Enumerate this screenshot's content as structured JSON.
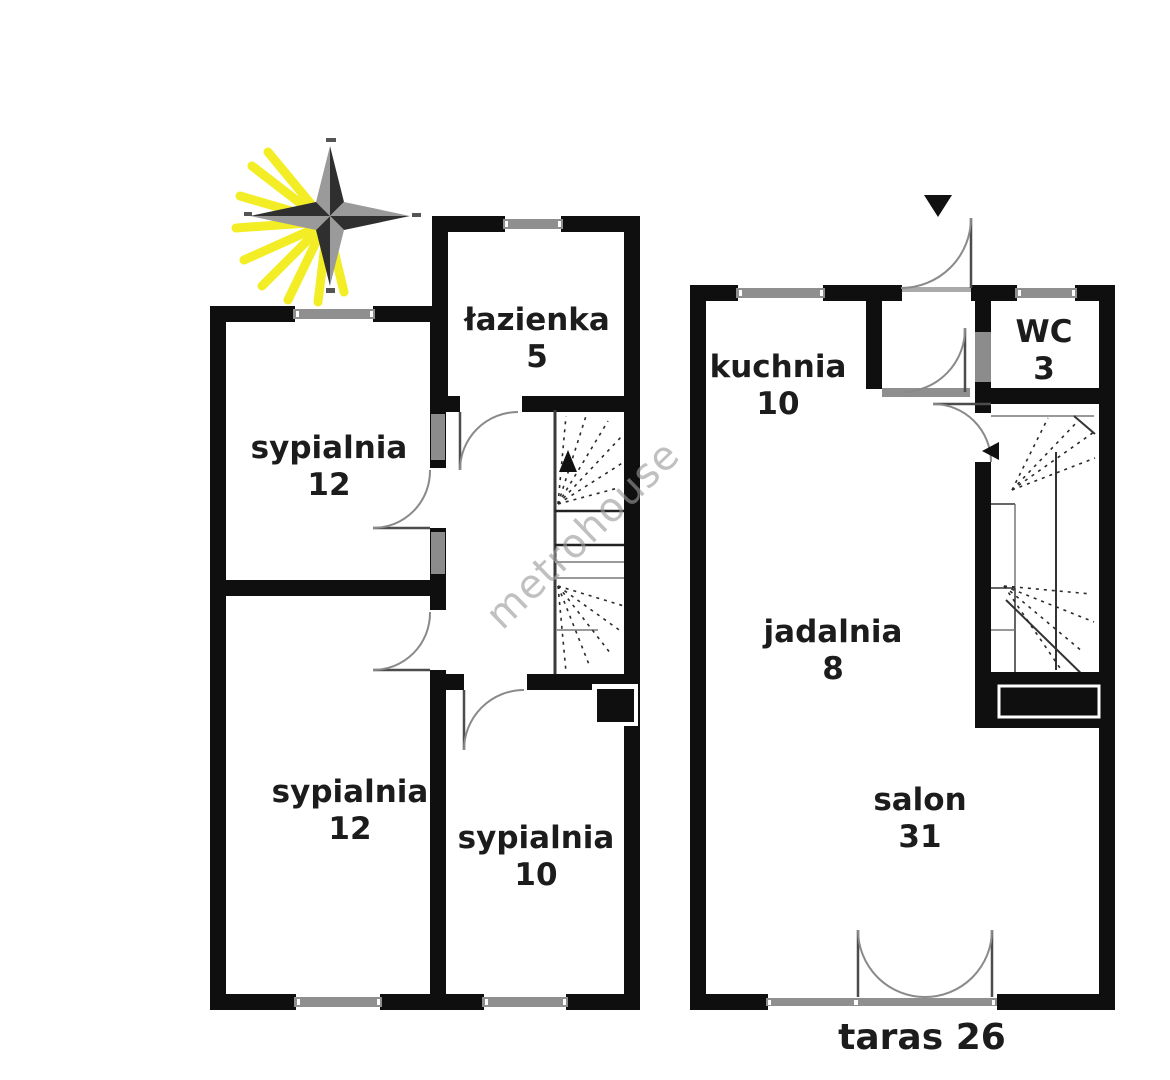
{
  "watermark": {
    "text": "metrohouse",
    "color": "#9b9b9b"
  },
  "icons": {
    "compass": "compass-rose-icon",
    "entrance": "entrance-arrow-icon",
    "stairs_up_upper_floor": "stairs-direction-arrow-icon",
    "stairs_up_ground_floor": "stairs-direction-arrow-icon"
  },
  "colors": {
    "wall": "#0f0f0f",
    "window_glass": "#8f8f8f",
    "door_arc": "#8a8a8a",
    "stair_line": "#2e2e2e",
    "compass_rays": "#f2ea00"
  },
  "rooms": {
    "upper": [
      {
        "name": "łazienka",
        "area": "5"
      },
      {
        "name": "sypialnia",
        "area": "12"
      },
      {
        "name": "sypialnia",
        "area": "12"
      },
      {
        "name": "sypialnia",
        "area": "10"
      }
    ],
    "ground": [
      {
        "name": "kuchnia",
        "area": "10"
      },
      {
        "name": "WC",
        "area": "3"
      },
      {
        "name": "jadalnia",
        "area": "8"
      },
      {
        "name": "salon",
        "area": "31"
      },
      {
        "name": "taras",
        "area": "26"
      }
    ]
  }
}
